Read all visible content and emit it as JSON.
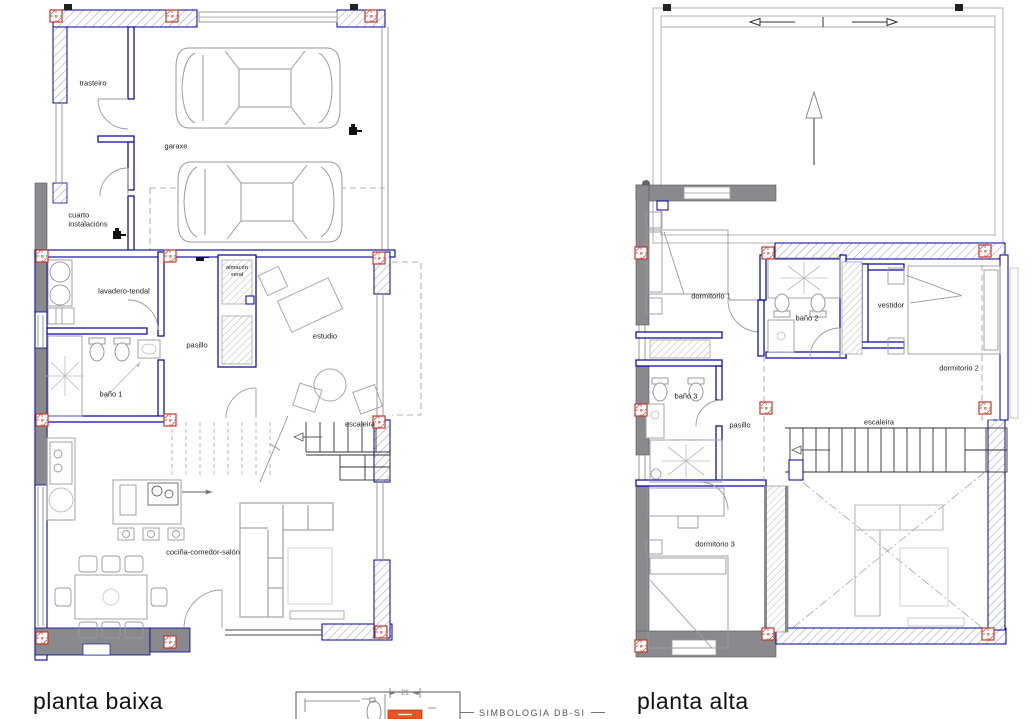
{
  "titles": {
    "planta_baixa": "planta baixa",
    "planta_alta": "planta alta"
  },
  "planta_baixa": {
    "rooms": {
      "trasteiro": "trasteiro",
      "garaxe": "garaxe",
      "cuarto_instalacions": "cuarto\ninstalacións",
      "lavadero_tendal": "lavadero-tendal",
      "pasillo": "pasillo",
      "bano_1": "baño 1",
      "almacen_xeral": "almacén\nxeral",
      "estudio": "estudio",
      "escaleira": "escaleira",
      "cocina_comedor_salon": "cociña-comedor-salón"
    }
  },
  "planta_alta": {
    "rooms": {
      "dormitorio_1": "dormitorio 1",
      "bano_2": "baño 2",
      "vestidor": "vestidor",
      "dormitorio_2": "dormitorio 2",
      "bano_3": "baño 3",
      "pasillo": "pasillo",
      "escaleira": "escaleira",
      "dormitorio_3": "dormitorio 3"
    }
  },
  "legend": {
    "title": "SIMBOLOGIA DB-SI",
    "dimension_label": "21"
  },
  "colors": {
    "wall_gray": "#8a8a8e",
    "line_navy": "#00009a",
    "line_light": "#9a9a9a",
    "furniture": "#a8a8a8",
    "column_red": "#c0392b",
    "extinguisher_orange": "#f05123",
    "text": "#1c1c1c"
  }
}
